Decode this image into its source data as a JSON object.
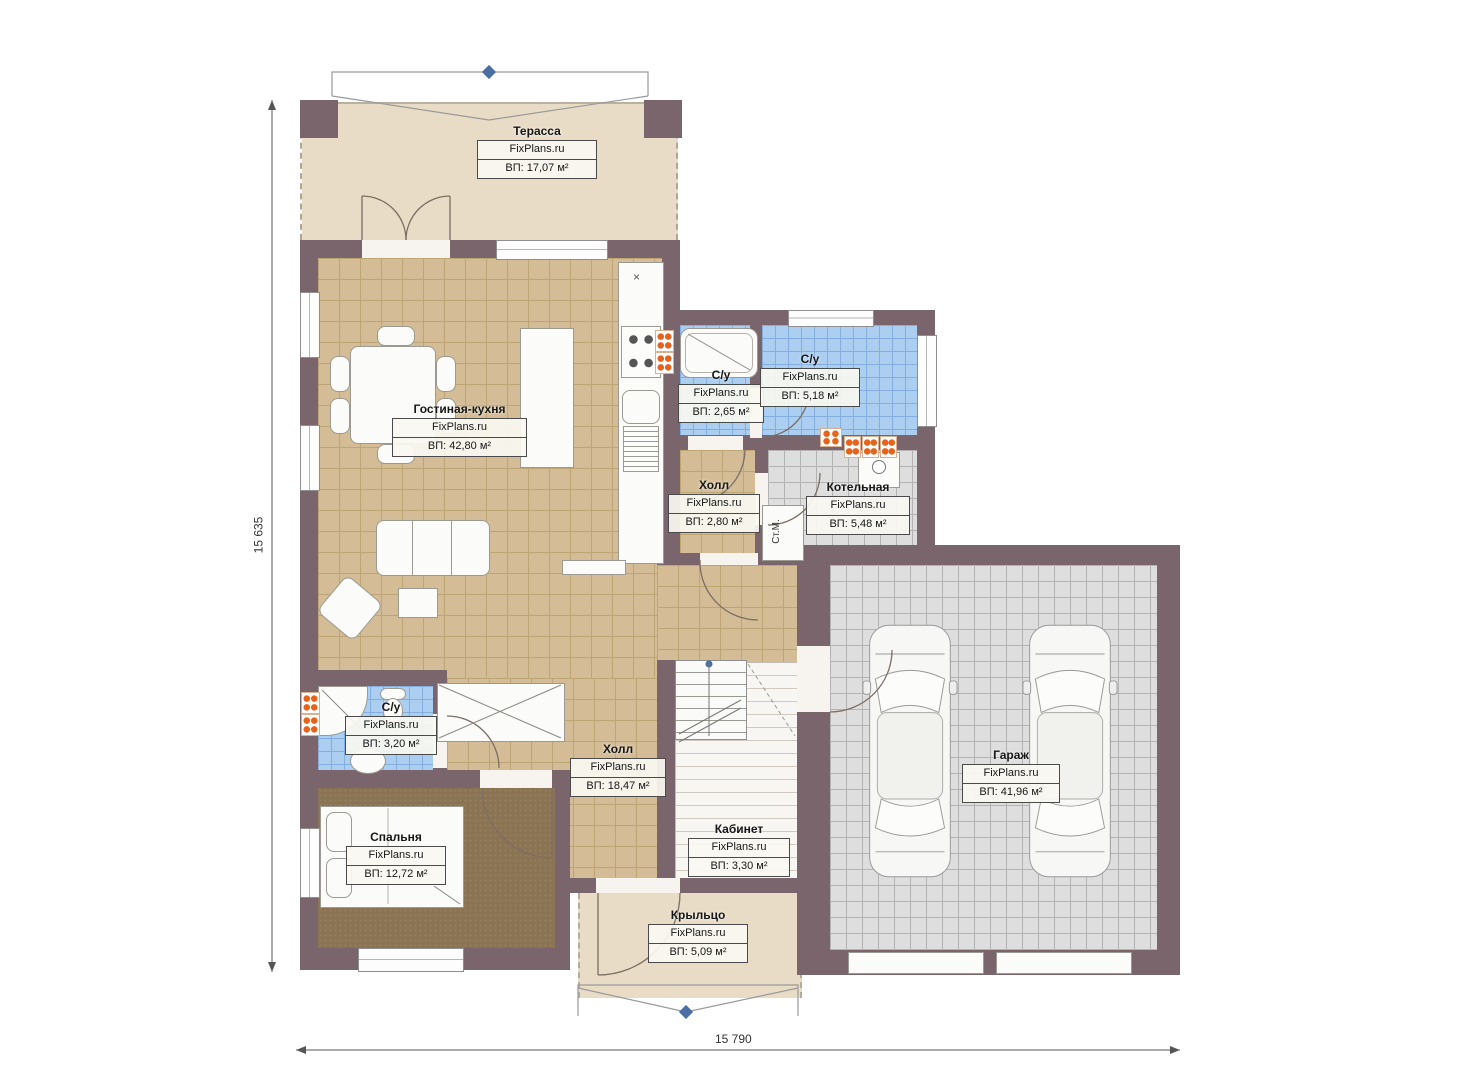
{
  "brand": "FixPlans.ru",
  "dimensions": {
    "left": "15 635",
    "bottom": "15 790"
  },
  "rooms": [
    {
      "key": "terrace",
      "name": "Терасса",
      "area": "ВП: 17,07 м²"
    },
    {
      "key": "living-kitchen",
      "name": "Гостиная-кухня",
      "area": "ВП: 42,80 м²"
    },
    {
      "key": "wc-2-65",
      "name": "С/у",
      "area": "ВП: 2,65 м²"
    },
    {
      "key": "wc-5-18",
      "name": "С/у",
      "area": "ВП: 5,18 м²"
    },
    {
      "key": "hall-2-80",
      "name": "Холл",
      "area": "ВП: 2,80 м²"
    },
    {
      "key": "boiler-room",
      "name": "Котельная",
      "area": "ВП: 5,48 м²"
    },
    {
      "key": "wc-3-20",
      "name": "С/у",
      "area": "ВП: 3,20 м²"
    },
    {
      "key": "hall-18-47",
      "name": "Холл",
      "area": "ВП: 18,47 м²"
    },
    {
      "key": "bedroom",
      "name": "Спальня",
      "area": "ВП: 12,72 м²"
    },
    {
      "key": "office",
      "name": "Кабинет",
      "area": "ВП: 3,30 м²"
    },
    {
      "key": "porch",
      "name": "Крыльцо",
      "area": "ВП: 5,09 м²"
    },
    {
      "key": "garage",
      "name": "Гараж",
      "area": "ВП: 41,96 м²"
    }
  ],
  "annotations": {
    "washing_machine": "Ст.М.",
    "x_mark": "×"
  },
  "colors": {
    "wall": "#7b656c",
    "terrace_floor": "#e9dcc6",
    "tile_tan": "#d4bd96",
    "tile_blue": "#abcef1",
    "tile_gray": "#dedede",
    "bedroom_floor": "#8b7454",
    "radiator_accent": "#e8621a",
    "marker": "#4a6fa5"
  }
}
